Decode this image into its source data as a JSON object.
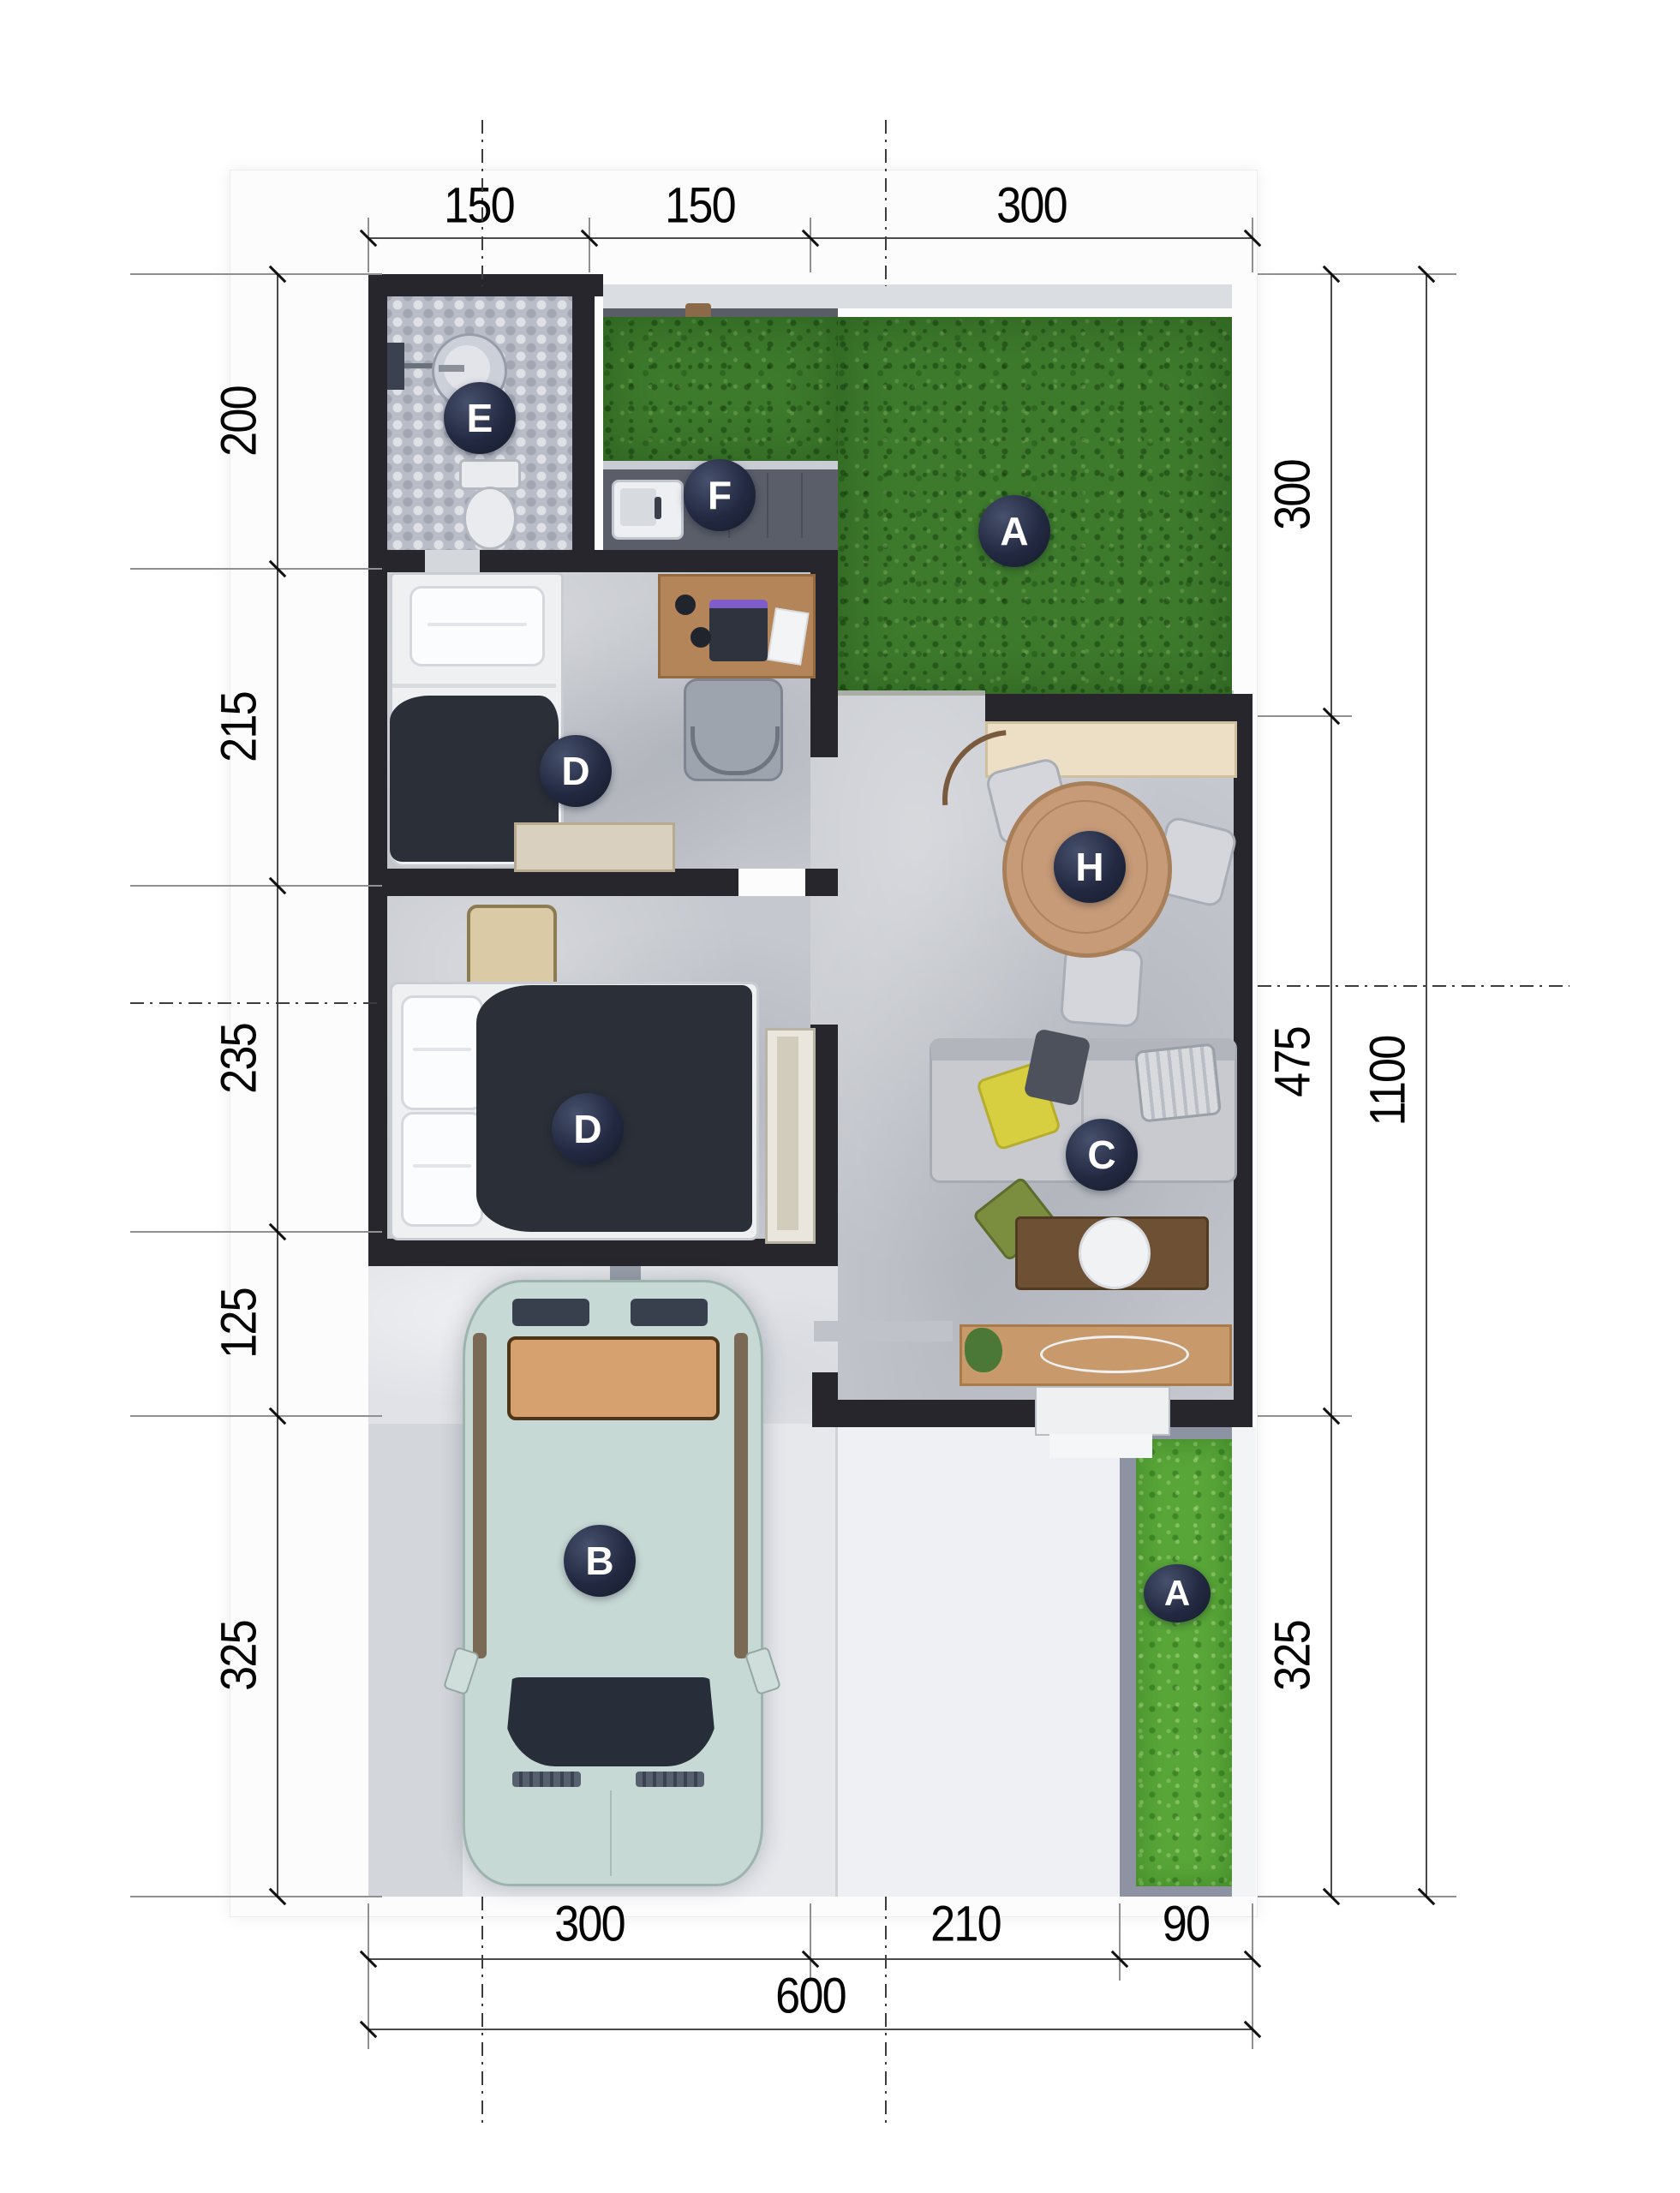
{
  "title": "house-floor-plan",
  "dims": {
    "top": [
      "150",
      "150",
      "300"
    ],
    "left": [
      "200",
      "215",
      "235",
      "125",
      "325"
    ],
    "right": [
      "300",
      "475",
      "325"
    ],
    "right_total": "1100",
    "bottom": [
      "300",
      "210",
      "90"
    ],
    "bottom_total": "600"
  },
  "markers": [
    {
      "letter": "E",
      "area": "bathroom"
    },
    {
      "letter": "F",
      "area": "kitchen"
    },
    {
      "letter": "A",
      "area": "garden-top"
    },
    {
      "letter": "D",
      "area": "bedroom-upper"
    },
    {
      "letter": "H",
      "area": "dining"
    },
    {
      "letter": "D",
      "area": "bedroom-lower"
    },
    {
      "letter": "C",
      "area": "living"
    },
    {
      "letter": "B",
      "area": "carport"
    },
    {
      "letter": "A",
      "area": "garden-side"
    }
  ],
  "colors": {
    "wall": "#26262c",
    "grass": "#3d7a2c",
    "grass_bright": "#58a538",
    "marker_bg": "#1e2438",
    "floor": "#c5c8ce",
    "car": "#c7d9d5",
    "wood": "#c79b78"
  }
}
